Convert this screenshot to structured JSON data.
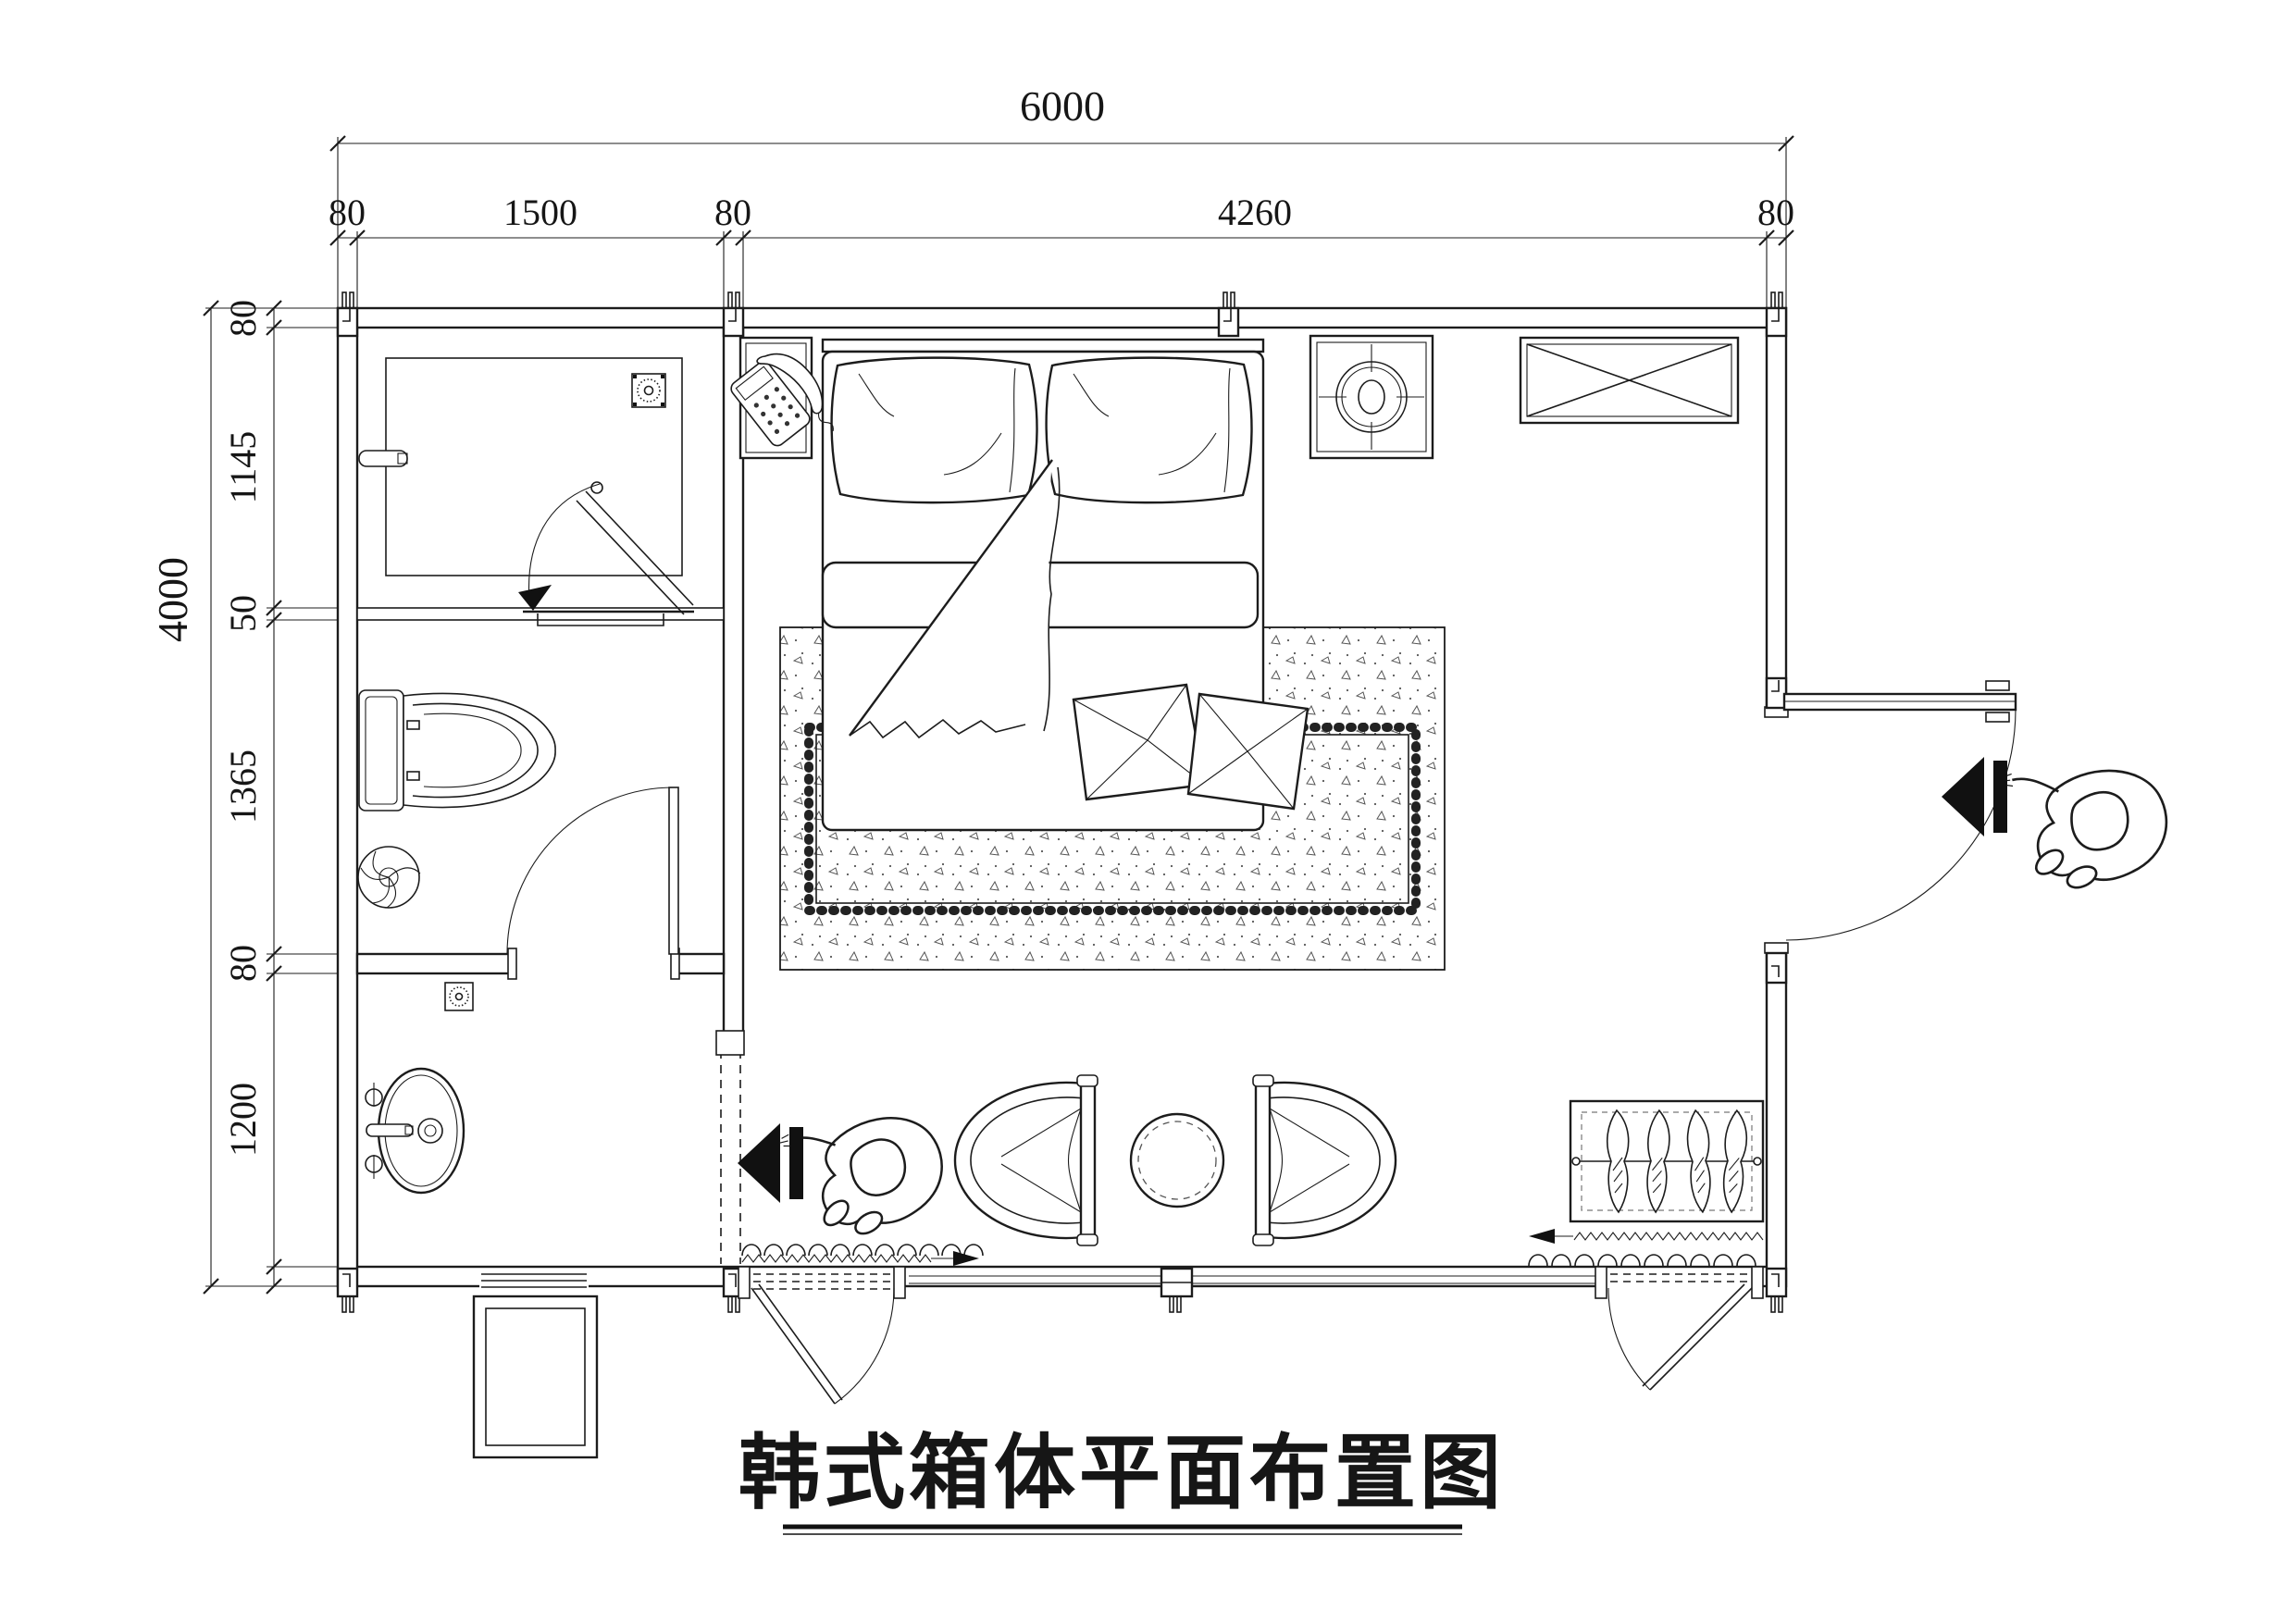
{
  "title": "韩式箱体平面布置图",
  "dims": {
    "top_total": "6000",
    "top_chain": [
      "80",
      "1500",
      "80",
      "4260",
      "80"
    ],
    "left_total": "4000",
    "left_chain": [
      "80",
      "1145",
      "50",
      "1365",
      "80",
      "1200"
    ],
    "bed_left": "500",
    "bed_width": "1800",
    "bed_right": "500",
    "bed_length": "2000",
    "nightstand_depth": "500",
    "cabinet_depth": "350",
    "cabinet_width": "900",
    "sink_counter": "505",
    "sink_room_depth": "1200",
    "chair_left": "701",
    "table_gap": "500",
    "chair_right": "701",
    "table_dia": "Ø500",
    "planter_width": "800",
    "planter_depth": "500"
  },
  "icons": {
    "telephone": "desk-phone-on-nightstand",
    "lamp": "round-lamp-on-nightstand",
    "floor_drain": "sunburst-square-drain",
    "spiral_drain": "spiral-circle-drain",
    "cabinet_cross": "crossed-box-cabinet",
    "person": "walking-person-top-view",
    "entry_arrow": "solid-entry-arrow"
  },
  "colors": {
    "line": "#1c1c1c",
    "background": "#ffffff"
  }
}
